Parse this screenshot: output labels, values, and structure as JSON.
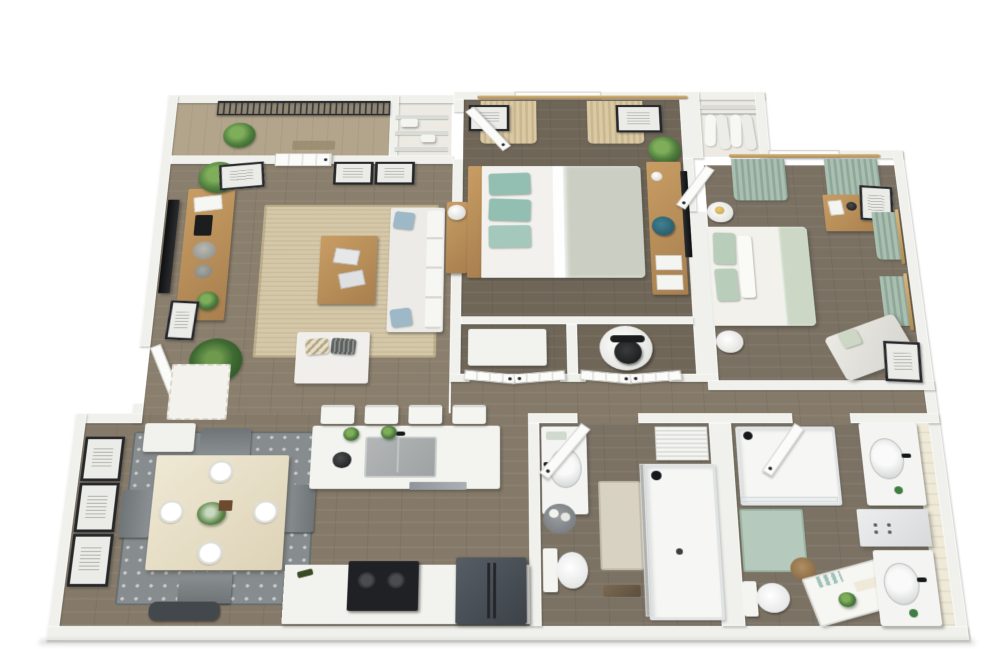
{
  "scene": {
    "type": "3d-floor-plan",
    "view": "top-down perspective render",
    "unit": "two-bedroom two-bathroom apartment with balcony",
    "background": "#ffffff"
  },
  "palette": {
    "wall": "#f0f1ec",
    "wallEdge": "#d9dbd4",
    "woodLiving": "#8a7e6d",
    "woodLower": "#857a69",
    "woodBed1": "#6f6658",
    "woodBed2": "#7a7163",
    "woodBath": "#7b7264",
    "concrete": "#b2a58c",
    "oak": "#c89d64",
    "oakDark": "#a87f4e",
    "jute": "#d5c8a9",
    "rugGray": "#878c8e",
    "teal": "#93bfb2",
    "sage": "#a9bfb0",
    "sageLight": "#ccd8c5",
    "beige": "#dbc9a4",
    "duvet": "#cbcfc3",
    "whiteF": "#f4f4f1",
    "black": "#1c1d1f",
    "fridge": "#474d54",
    "railing": "#2c2c2e",
    "plant": "#4e7d3d",
    "plantDark": "#2f5526",
    "matGreen": "#b5cabc",
    "matBeige": "#d8d2c2",
    "blue": "#9db8c6",
    "chairGray": "#7e8487",
    "benchDark": "#43484c",
    "steel": "#9aa0a3",
    "gold": "#c9a24f"
  },
  "rooms": [
    {
      "name": "Living Room",
      "furniture": [
        "wall tv",
        "oak media console",
        "jute area rug",
        "oak coffee table with magazines",
        "white sofa with blue pillows",
        "sofa console with orb lamp",
        "white armchair with patterned pillows",
        "fiddle leaf plant",
        "palm plant",
        "leaning art frame",
        "two botanical wall frames",
        "corner art frame",
        "entry door with doormat",
        "balcony door"
      ]
    },
    {
      "name": "Balcony",
      "furniture": [
        "black mesh railing",
        "concrete floor",
        "aloe plant",
        "outdoor mat",
        "wire shelving storage closet"
      ]
    },
    {
      "name": "Dining Area",
      "furniture": [
        "square dining table with four place settings",
        "floral centerpiece",
        "four gray chairs",
        "gray patterned rug",
        "dark bench",
        "three stacked wall frames",
        "white entry cabinet"
      ]
    },
    {
      "name": "Kitchen",
      "furniture": [
        "white island with undermount sink and faucet",
        "two herb plants",
        "dishwasher",
        "four white bar stools",
        "counter run with black range",
        "dark refrigerator"
      ]
    },
    {
      "name": "Primary Bedroom",
      "furniture": [
        "queen bed with teal pillows and oak headboard",
        "beige curtains with wood rod",
        "window",
        "two wall frames",
        "oak media desk with wall tv",
        "teal desk chair",
        "corner plant",
        "entry door"
      ]
    },
    {
      "name": "Primary Closet",
      "furniture": [
        "wire shelves",
        "folded linens"
      ]
    },
    {
      "name": "Desk Nooks",
      "furniture": [
        "white built-in desk",
        "round table with black office chair",
        "bifold doors"
      ]
    },
    {
      "name": "Primary Bathroom",
      "furniture": [
        "vanity with sink",
        "toilet",
        "walk-in shower with black shower head",
        "beige bath mat",
        "towel basket",
        "wood bench",
        "louvered linen cabinet",
        "door"
      ]
    },
    {
      "name": "Bedroom Two",
      "furniture": [
        "bed with sage pillows and throw",
        "two round side tables",
        "sage curtains on rods",
        "oak dresser with camera",
        "leaning art frames",
        "chaise lounge with sage pillow",
        "door"
      ]
    },
    {
      "name": "Bedroom Two Closet",
      "furniture": [
        "hanging white garments",
        "closet rod and shelf"
      ]
    },
    {
      "name": "Bathroom Two",
      "furniture": [
        "tub shower with black shower head",
        "green bath mat",
        "toilet",
        "wicker basket",
        "ladder towel shelf with plant",
        "double vanity with two sinks",
        "center storage cabinet",
        "door"
      ]
    },
    {
      "name": "Hallway",
      "furniture": []
    }
  ]
}
